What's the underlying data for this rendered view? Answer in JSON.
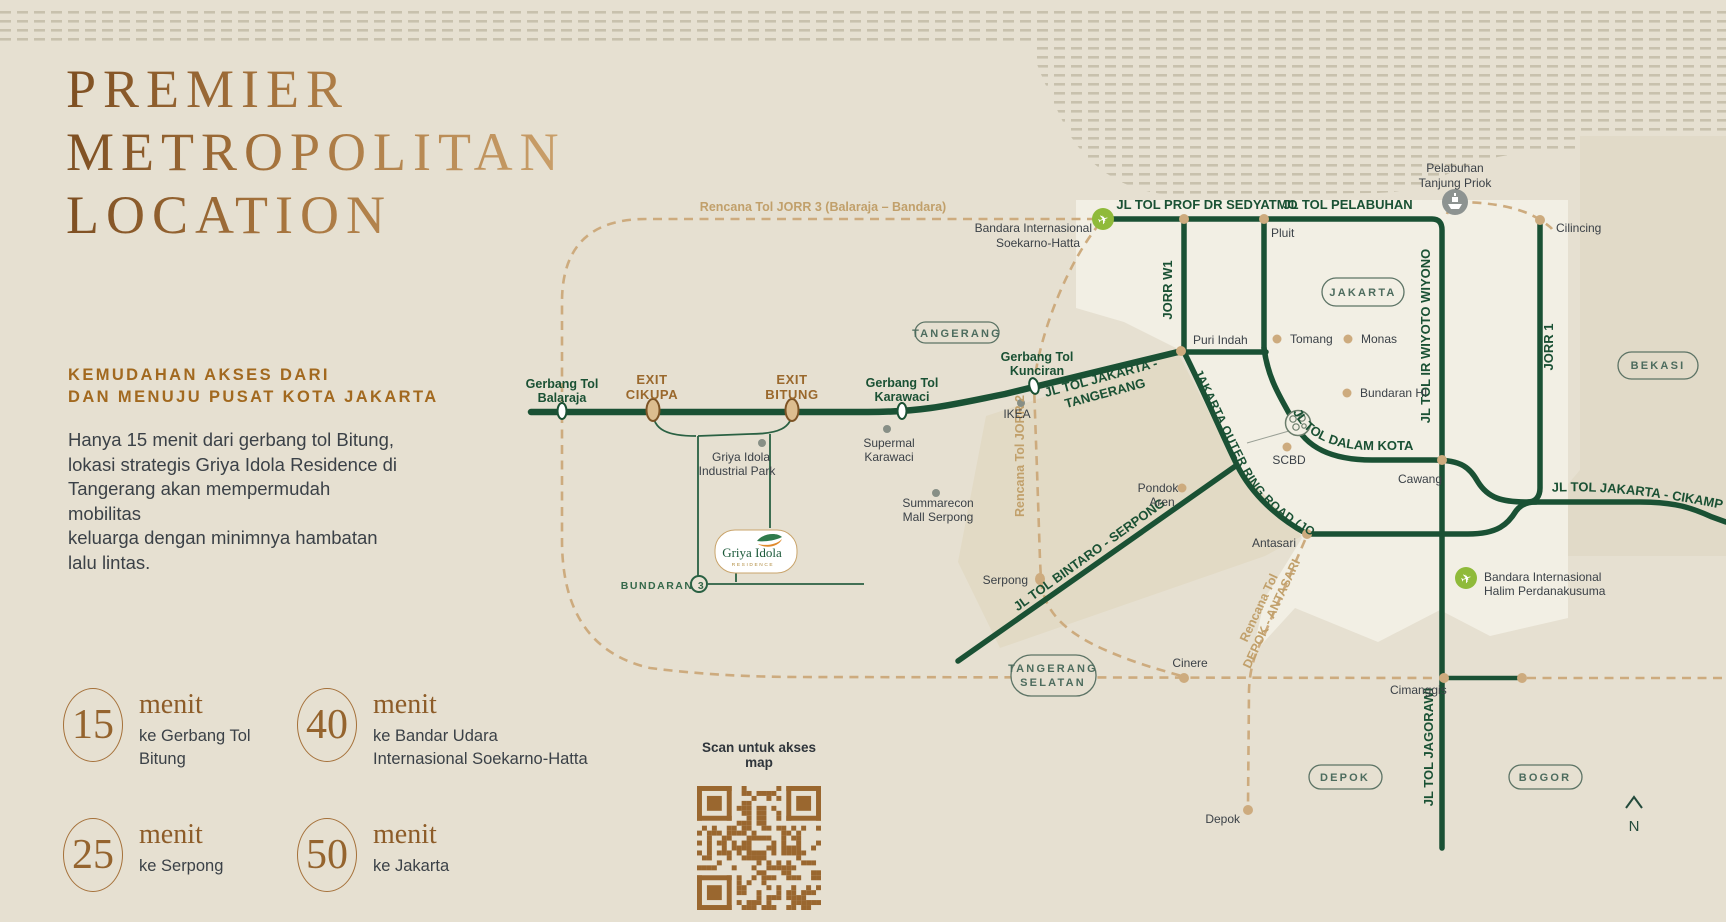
{
  "poster": {
    "title_lines": [
      "PREMIER",
      "METROPOLITAN",
      "LOCATION"
    ],
    "intro": {
      "heading_lines": [
        "KEMUDAHAN AKSES DARI",
        "DAN MENUJU PUSAT KOTA JAKARTA"
      ],
      "body_lines": [
        "Hanya 15 menit dari gerbang tol Bitung,",
        "lokasi strategis Griya Idola Residence di",
        "Tangerang akan mempermudah mobilitas",
        "keluarga dengan minimnya hambatan",
        "lalu lintas."
      ]
    },
    "stats": [
      {
        "value": "15",
        "unit": "menit",
        "desc_lines": [
          "ke Gerbang Tol",
          "Bitung"
        ]
      },
      {
        "value": "40",
        "unit": "menit",
        "desc_lines": [
          "ke Bandar Udara",
          "Internasional Soekarno-Hatta"
        ]
      },
      {
        "value": "25",
        "unit": "menit",
        "desc_lines": [
          "ke Serpong"
        ]
      },
      {
        "value": "50",
        "unit": "menit",
        "desc_lines": [
          "ke Jakarta"
        ]
      }
    ],
    "qr_caption": "Scan untuk akses map",
    "compass_label": "N"
  },
  "logo": {
    "name": "Griya Idola",
    "subtitle": "RESIDENCE"
  },
  "map": {
    "jorr3": "Rencana Tol JORR 3 (Balaraja – Bandara)",
    "soetta1": "Bandara Internasional",
    "soetta2": "Soekarno-Hatta",
    "sedyatmo": "JL TOL PROF DR SEDYATMO",
    "tol_pelabuhan": "JL TOL PELABUHAN",
    "priok1": "Pelabuhan",
    "priok2": "Tanjung Priok",
    "cilincing": "Cilincing",
    "pluit": "Pluit",
    "jorr_w1": "JORR W1",
    "jakarta_badge": "JAKARTA",
    "puri_indah": "Puri Indah",
    "tomang": "Tomang",
    "monas": "Monas",
    "bundaran_hi": "Bundaran HI",
    "wiyoto": "JL TOL IR WIYOTO WIYONO",
    "jorr1_v": "JORR 1",
    "bekasi_badge": "BEKASI",
    "tangerang_badge": "TANGERANG",
    "balaraja1": "Gerbang Tol",
    "balaraja2": "Balaraja",
    "cikupa1": "EXIT",
    "cikupa2": "CIKUPA",
    "bitung1": "EXIT",
    "bitung2": "BITUNG",
    "karawaci1": "Gerbang Tol",
    "karawaci2": "Karawaci",
    "kunciran1": "Gerbang Tol",
    "kunciran2": "Kunciran",
    "jkt_tng1": "JL TOL JAKARTA -",
    "jkt_tng2": "TANGERANG",
    "ikea": "IKEA",
    "supermal1": "Supermal",
    "supermal2": "Karawaci",
    "giip1": "Griya Idola",
    "giip2": "Industrial Park",
    "jorr2": "Rencana Tol JORR 2",
    "summarecon1": "Summarecon",
    "summarecon2": "Mall Serpong",
    "outer_ring": "JAKARTA OUTER RING ROAD (JORR 1)",
    "dalam_kota": "JL TOL DALAM KOTA",
    "scbd": "SCBD",
    "cawang": "Cawang",
    "cikampek": "JL TOL JAKARTA - CIKAMPEK",
    "bintaro": "JL TOL BINTARO - SERPONG",
    "pondok1": "Pondok",
    "pondok2": "Aren",
    "antasari": "Antasari",
    "halim1": "Bandara Internasional",
    "halim2": "Halim Perdanakusuma",
    "serpong": "Serpong",
    "tsel1": "TANGERANG",
    "tsel2": "SELATAN",
    "depok_ant1": "Rencana Tol",
    "depok_ant2": "DEPOK - ANTASARI",
    "cinere": "Cinere",
    "cimanggis": "Cimanggis",
    "jagorawi": "JL TOL JAGORAWI",
    "depok_badge": "DEPOK",
    "bogor_badge": "BOGOR",
    "depok_city": "Depok",
    "bundaran3": "BUNDARAN 3"
  },
  "colors": {
    "background": "#e6e0d1",
    "jakarta_light": "#f2efe4",
    "shade_tan": "#e1d9c4",
    "road_green": "#1a5134",
    "dash_tan": "#cdab7e",
    "bronze": "#8d5c28",
    "title_gradient": [
      "#7e4f22",
      "#caa06b"
    ],
    "qr_brown": "#9a672f",
    "airport_green": "#8fba3a",
    "port_gray": "#8d9391",
    "text_dark": "#3b4147",
    "exit_brown": "#9a682c",
    "tan_label": "#c1a06b",
    "badge_green": "#4d6c5e"
  }
}
